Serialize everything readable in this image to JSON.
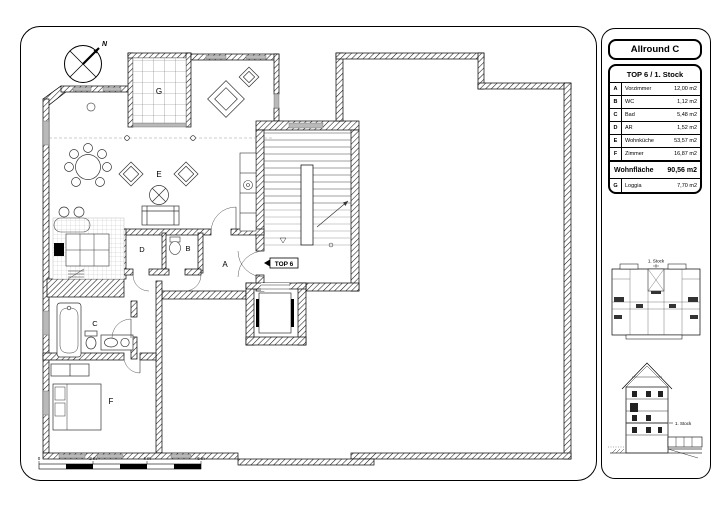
{
  "panel": {
    "title": "Allround C",
    "table": {
      "header": "TOP 6 / 1. Stock",
      "rows": [
        {
          "key": "A",
          "name": "Vorzimmer",
          "area": "12,00 m2"
        },
        {
          "key": "B",
          "name": "WC",
          "area": "1,12 m2"
        },
        {
          "key": "C",
          "name": "Bad",
          "area": "5,48 m2"
        },
        {
          "key": "D",
          "name": "AR",
          "area": "1,52 m2"
        },
        {
          "key": "E",
          "name": "Wohnküche",
          "area": "53,57 m2"
        },
        {
          "key": "F",
          "name": "Zimmer",
          "area": "16,87 m2"
        }
      ],
      "total": {
        "label": "Wohnfläche",
        "area": "90,56 m2"
      },
      "loggia_row": {
        "key": "G",
        "name": "Loggia",
        "area": "7,70 m2"
      }
    },
    "keyplan": {
      "label": "1. Stock"
    },
    "section": {
      "label": "1. Stock"
    }
  },
  "plan": {
    "north_label": "N",
    "unit_tag": "TOP 6",
    "room_labels": {
      "A": "A",
      "B": "B",
      "C": "C",
      "D": "D",
      "E": "E",
      "F": "F",
      "G": "G"
    },
    "scalebar": {
      "ticks": [
        "0",
        "2 m",
        "4 m",
        "6 m"
      ]
    }
  },
  "colors": {
    "ink": "#000000",
    "window": "#b9b9b9",
    "grid": "#8a8a8a",
    "tile": "#d8d8d8"
  }
}
